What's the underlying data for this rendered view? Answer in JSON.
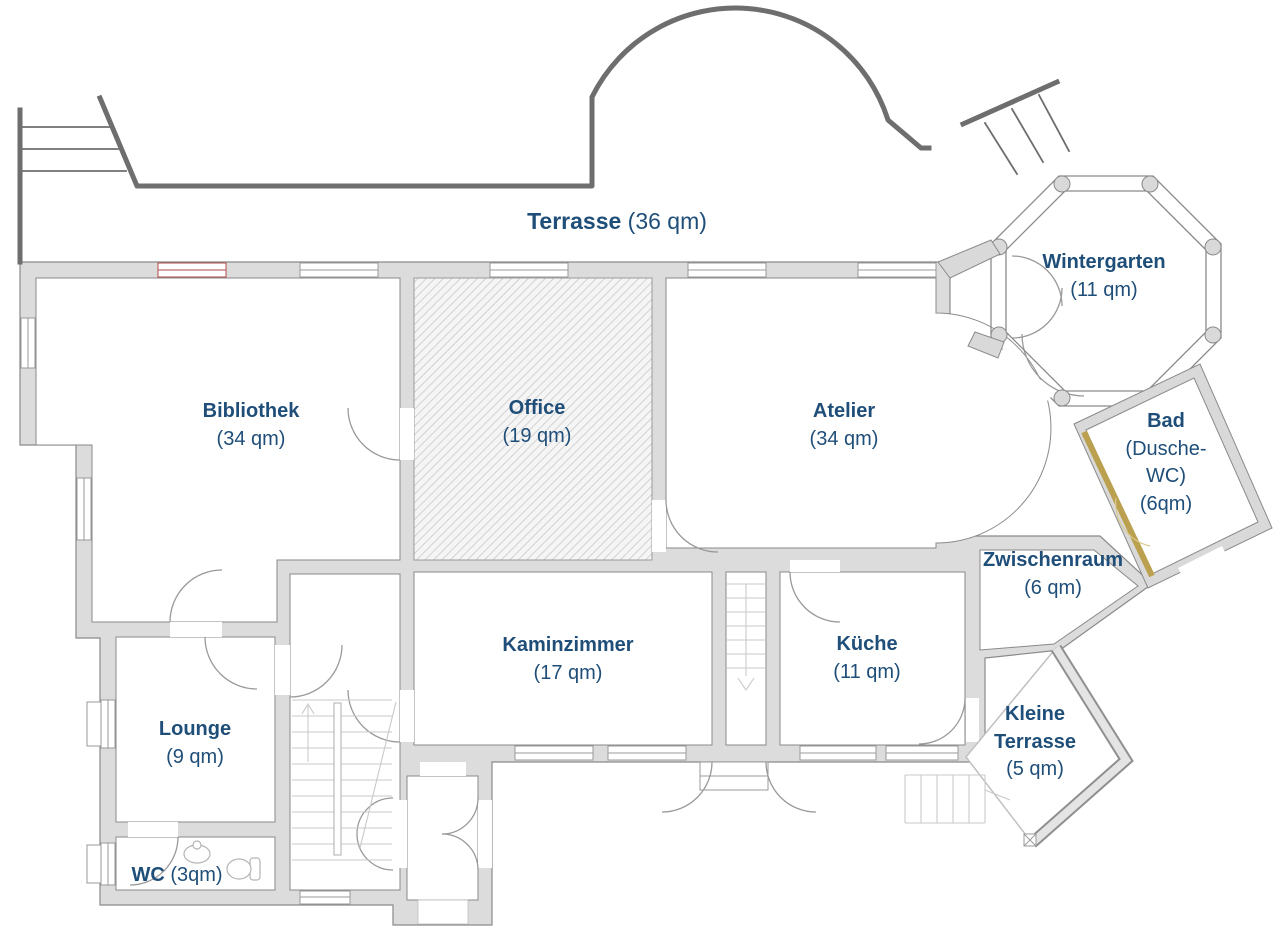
{
  "title": "Grundriss Erdgeschoss",
  "colors": {
    "label_text": "#1f4e79",
    "wall_fill": "#dcdcdc",
    "wall_stroke": "#8a8a8a",
    "terrace_wall": "#6e6e6e",
    "highlight_wall": "#bba14f",
    "window_accent": "#b24b4b",
    "hatch_line": "#c9c9c9"
  },
  "rooms": [
    {
      "id": "terrasse",
      "name": "Terrasse",
      "area": "(36 qm)"
    },
    {
      "id": "wintergarten",
      "name": "Wintergarten",
      "area": "(11 qm)"
    },
    {
      "id": "bibliothek",
      "name": "Bibliothek",
      "area": "(34 qm)"
    },
    {
      "id": "office",
      "name": "Office",
      "area": "(19 qm)"
    },
    {
      "id": "atelier",
      "name": "Atelier",
      "area": "(34 qm)"
    },
    {
      "id": "bad",
      "name": "Bad",
      "detail": "(Dusche-WC)",
      "area": "(6qm)"
    },
    {
      "id": "zwischenraum",
      "name": "Zwischenraum",
      "area": "(6 qm)"
    },
    {
      "id": "kaminzimmer",
      "name": "Kaminzimmer",
      "area": "(17 qm)"
    },
    {
      "id": "kueche",
      "name": "Küche",
      "area": "(11 qm)"
    },
    {
      "id": "lounge",
      "name": "Lounge",
      "area": "(9 qm)"
    },
    {
      "id": "kleine_terrasse",
      "name": "Kleine Terrasse",
      "area": "(5 qm)"
    },
    {
      "id": "wc",
      "name": "WC",
      "area": "(3qm)"
    }
  ]
}
